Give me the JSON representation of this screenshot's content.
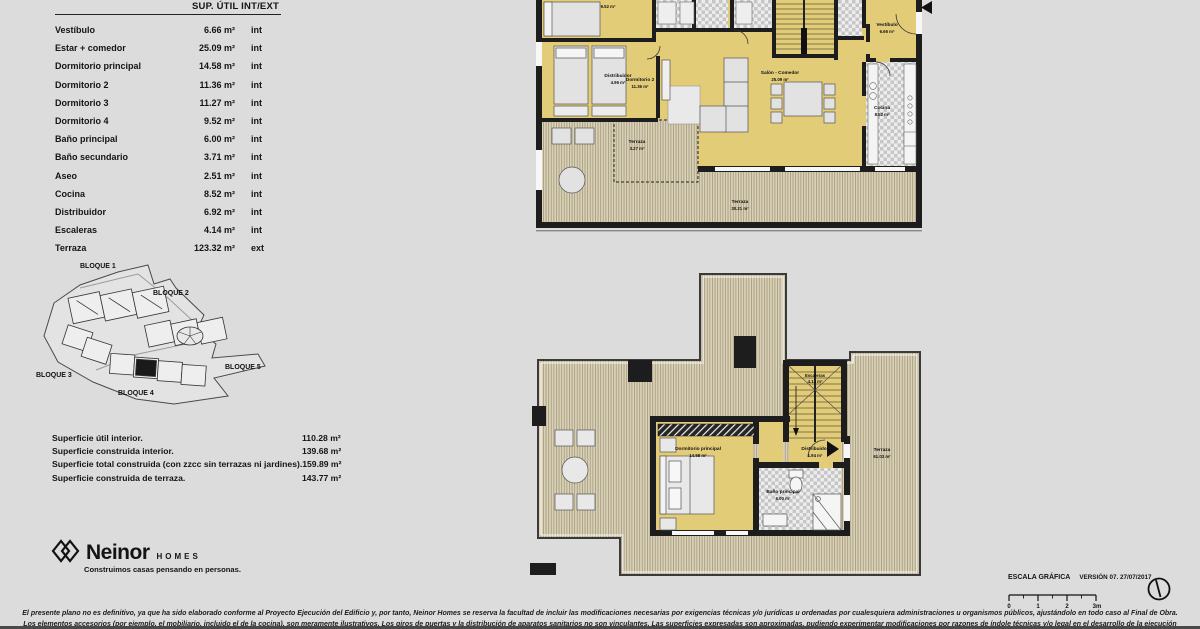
{
  "colors": {
    "background": "#dcdcdc",
    "plan_floor_yellow": "#e3cc78",
    "terrace_deck": "#dad1b7",
    "wall_black": "#1d1d1d",
    "tile_gray": "#c6c6c6"
  },
  "table": {
    "header": "SUP. ÚTIL INT/EXT",
    "rows": [
      {
        "label": "Vestíbulo",
        "area": "6.66 m²",
        "type": "int"
      },
      {
        "label": "Estar + comedor",
        "area": "25.09 m²",
        "type": "int"
      },
      {
        "label": "Dormitorio principal",
        "area": "14.58 m²",
        "type": "int"
      },
      {
        "label": "Dormitorio 2",
        "area": "11.36 m²",
        "type": "int"
      },
      {
        "label": "Dormitorio 3",
        "area": "11.27 m²",
        "type": "int"
      },
      {
        "label": "Dormitorio 4",
        "area": "9.52 m²",
        "type": "int"
      },
      {
        "label": "Baño principal",
        "area": "6.00 m²",
        "type": "int"
      },
      {
        "label": "Baño secundario",
        "area": "3.71 m²",
        "type": "int"
      },
      {
        "label": "Aseo",
        "area": "2.51 m²",
        "type": "int"
      },
      {
        "label": "Cocina",
        "area": "8.52 m²",
        "type": "int"
      },
      {
        "label": "Distribuidor",
        "area": "6.92 m²",
        "type": "int"
      },
      {
        "label": "Escaleras",
        "area": "4.14 m²",
        "type": "int"
      },
      {
        "label": "Terraza",
        "area": "123.32 m²",
        "type": "ext"
      }
    ]
  },
  "site": {
    "blocks": [
      "BLOQUE 1",
      "BLOQUE 2",
      "BLOQUE 3",
      "BLOQUE 4",
      "BLOQUE 5"
    ]
  },
  "summary": {
    "rows": [
      {
        "label": "Superficie útil interior.",
        "value": "110.28 m²"
      },
      {
        "label": "Superficie construida interior.",
        "value": "139.68 m²"
      },
      {
        "label": "Superficie total construida (con zzcc sin terrazas ni jardines).",
        "value": "159.89 m²"
      },
      {
        "label": "Superficie construida de terraza.",
        "value": "143.77 m²"
      }
    ]
  },
  "brand": {
    "name": "Neinor",
    "word": "HOMES",
    "tagline": "Construimos casas pensando en personas."
  },
  "plans": {
    "upper": {
      "rooms": [
        {
          "area": "9.52 m²"
        },
        {
          "name": "Distribuidor",
          "area": "4.96 m²"
        },
        {
          "name": "Vestíbulo",
          "area": "6.66 m²"
        },
        {
          "name": "Dormitorio 2",
          "area": "11.36 m²"
        },
        {
          "name": "Salón - Comedor",
          "area": "25.09 m²"
        },
        {
          "name": "Cocina",
          "area": "8.52 m²"
        },
        {
          "name": "Terraza",
          "area": "3.27 m²"
        },
        {
          "name": "Terraza",
          "area": "30.21 m²"
        }
      ]
    },
    "lower": {
      "rooms": [
        {
          "name": "Escaleras",
          "area": "4.14 m²"
        },
        {
          "name": "Dormitorio principal",
          "area": "14.58 m²"
        },
        {
          "name": "Distribuidor",
          "area": "1.94 m²"
        },
        {
          "name": "Baño principal",
          "area": "6.00 m²"
        },
        {
          "name": "Terraza",
          "area": "61.03 m²"
        }
      ]
    }
  },
  "scale": {
    "title": "ESCALA GRÁFICA",
    "version": "VERSIÓN 07. 27/07/2017",
    "ticks": [
      "0",
      "1",
      "2",
      "3m"
    ]
  },
  "legal": {
    "line1": "El presente plano no es definitivo, ya que ha sido elaborado conforme al Proyecto Ejecución del Edificio y, por tanto, Neinor Homes se reserva la facultad de incluir las modificaciones necesarias por exigencias técnicas y/o jurídicas u ordenadas por cualesquiera administraciones u organismos públicos, ajustándolo en todo caso al Final de Obra.",
    "line2": "Los elementos accesorios (por ejemplo, el mobiliario, incluido el de la cocina), son meramente ilustrativos. Los giros de puertas y la distribución de aparatos sanitarios no son vinculantes. Las superficies expresadas son aproximadas, pudiendo experimentar modificaciones por razones de índole técnicas y/o legal en el desarrollo de la ejecución de las obras."
  }
}
